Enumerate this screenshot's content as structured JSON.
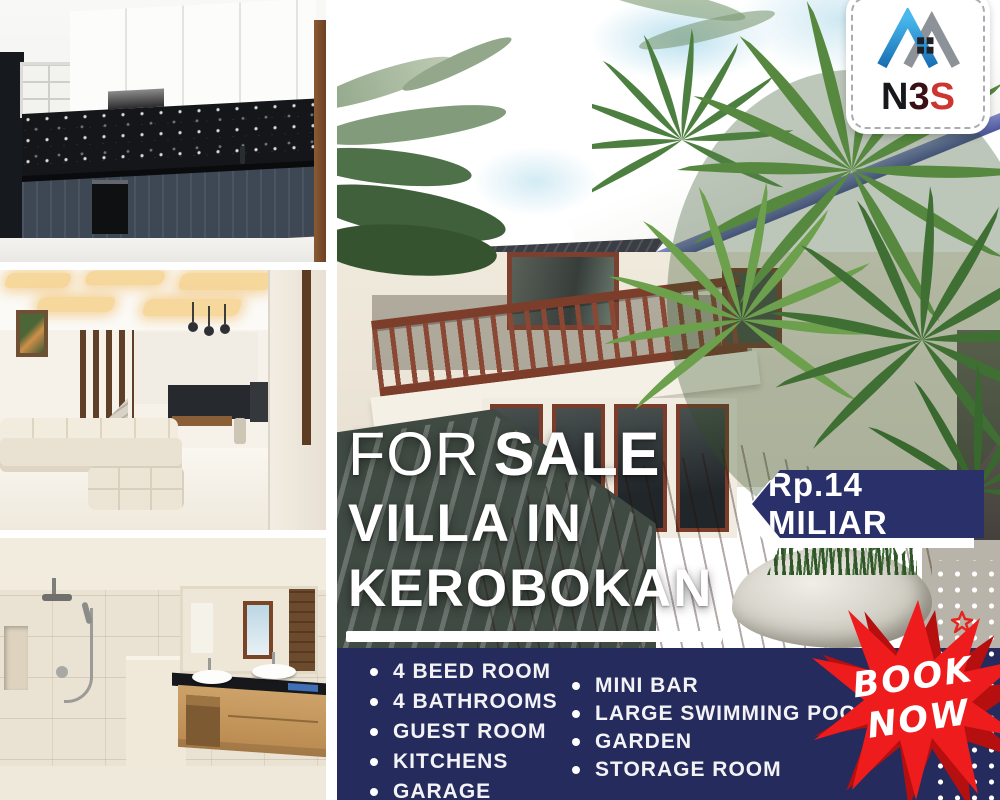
{
  "logo": {
    "letters": [
      "N",
      "3",
      "S"
    ],
    "icon": "twin-roof-house"
  },
  "headline": {
    "for": "FOR",
    "sale": "SALE",
    "villa_in": "VILLA IN",
    "kerobokan": "KEROBOKAN"
  },
  "price_tag": {
    "text": "Rp.14 MILIAR"
  },
  "features": {
    "left": [
      "4 BEED ROOM",
      "4 BATHROOMS",
      "GUEST ROOM",
      "KITCHENS",
      "GARAGE"
    ],
    "right": [
      "MINI BAR",
      "LARGE SWIMMING POOL",
      "GARDEN",
      "STORAGE ROOM"
    ]
  },
  "cta": {
    "book": "BOOK",
    "now": "NOW"
  },
  "colors": {
    "panel_navy": "#262b5e",
    "ribbon_navy": "#2a3069",
    "cta_red": "#ee1c1c",
    "logo_blue": "#2d9ade",
    "logo_gray": "#8d9298",
    "logo_red": "#cd3531"
  },
  "photos": {
    "kitchen": "kitchen with white upper cabinets, black mosaic backsplash and dark lower cabinets",
    "living_room": "living room with cream sectional sofa, coffered glowing ceiling and stairs",
    "bathroom": "bathroom with beige stone tiles, walk-in shower and wooden double vanity",
    "villa": "two-storey villa exterior with pool, wooden deck and tropical plants"
  }
}
